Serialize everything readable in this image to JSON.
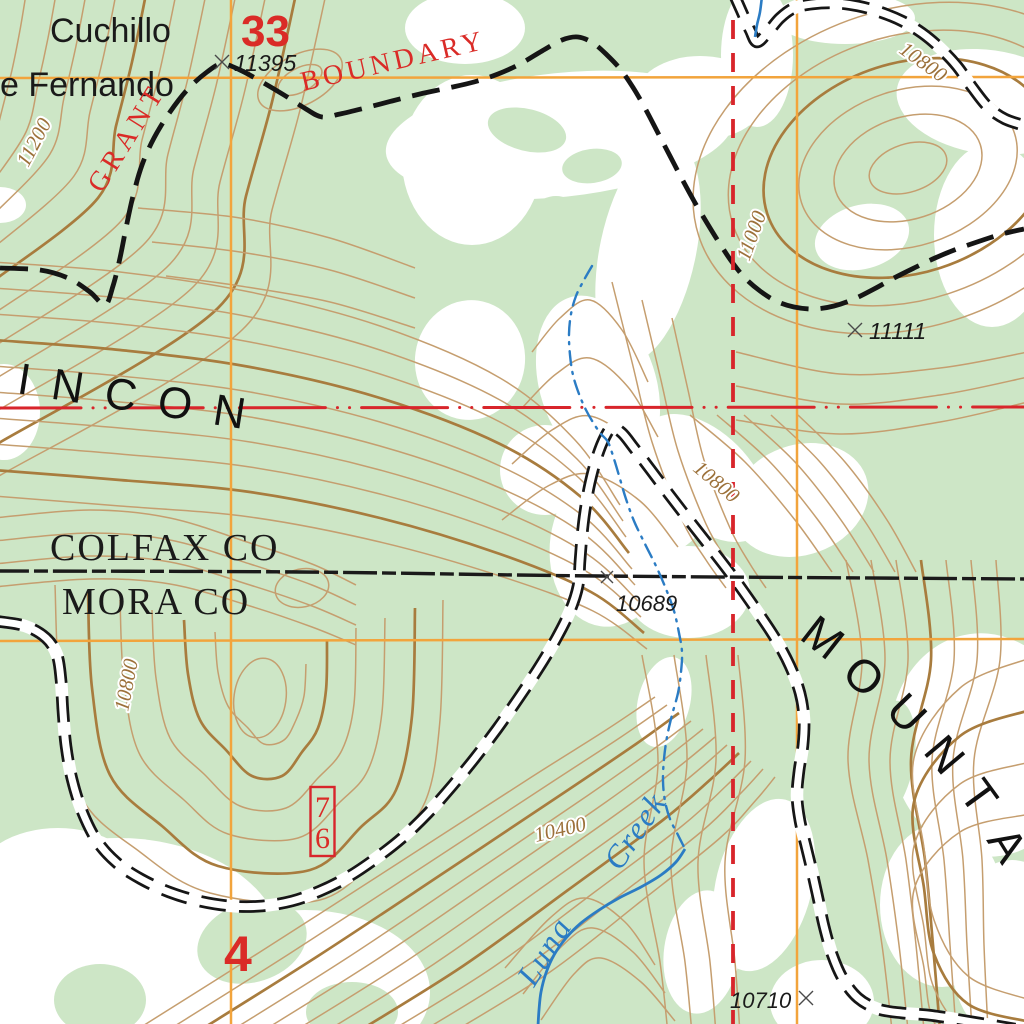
{
  "labels": {
    "place1": "Cuchillo",
    "place2": "e Fernando",
    "section_upper": "33",
    "section_lower": "4",
    "grant": "GRANT",
    "boundary": "BOUNDARY",
    "county_north": "COLFAX CO",
    "county_south": "MORA CO",
    "ridge": "INCON",
    "mountain": [
      "M",
      "O",
      "U",
      "N",
      "T",
      "A"
    ],
    "creek1": "Luna",
    "creek2": "Creek",
    "route": [
      "7",
      "6"
    ],
    "spots": {
      "s11395": "11395",
      "s11111": "11111",
      "s10689": "10689",
      "s10710": "10710"
    },
    "contours": {
      "c11200": "11200",
      "c10800ne": "10800",
      "c11000": "11000",
      "c10800c": "10800",
      "c10800w": "10800",
      "c10400": "10400"
    }
  },
  "colors": {
    "vegetation": "#cde6c6",
    "clearing": "#ffffff",
    "contour": "#c59e6f",
    "contour_index": "#a87c3e",
    "water": "#2b7cc4",
    "grid": "#f2a43c",
    "red_line": "#d8252b",
    "red_text": "#da2b27",
    "black": "#1a1a1a",
    "label_brown": "#9c713a"
  }
}
